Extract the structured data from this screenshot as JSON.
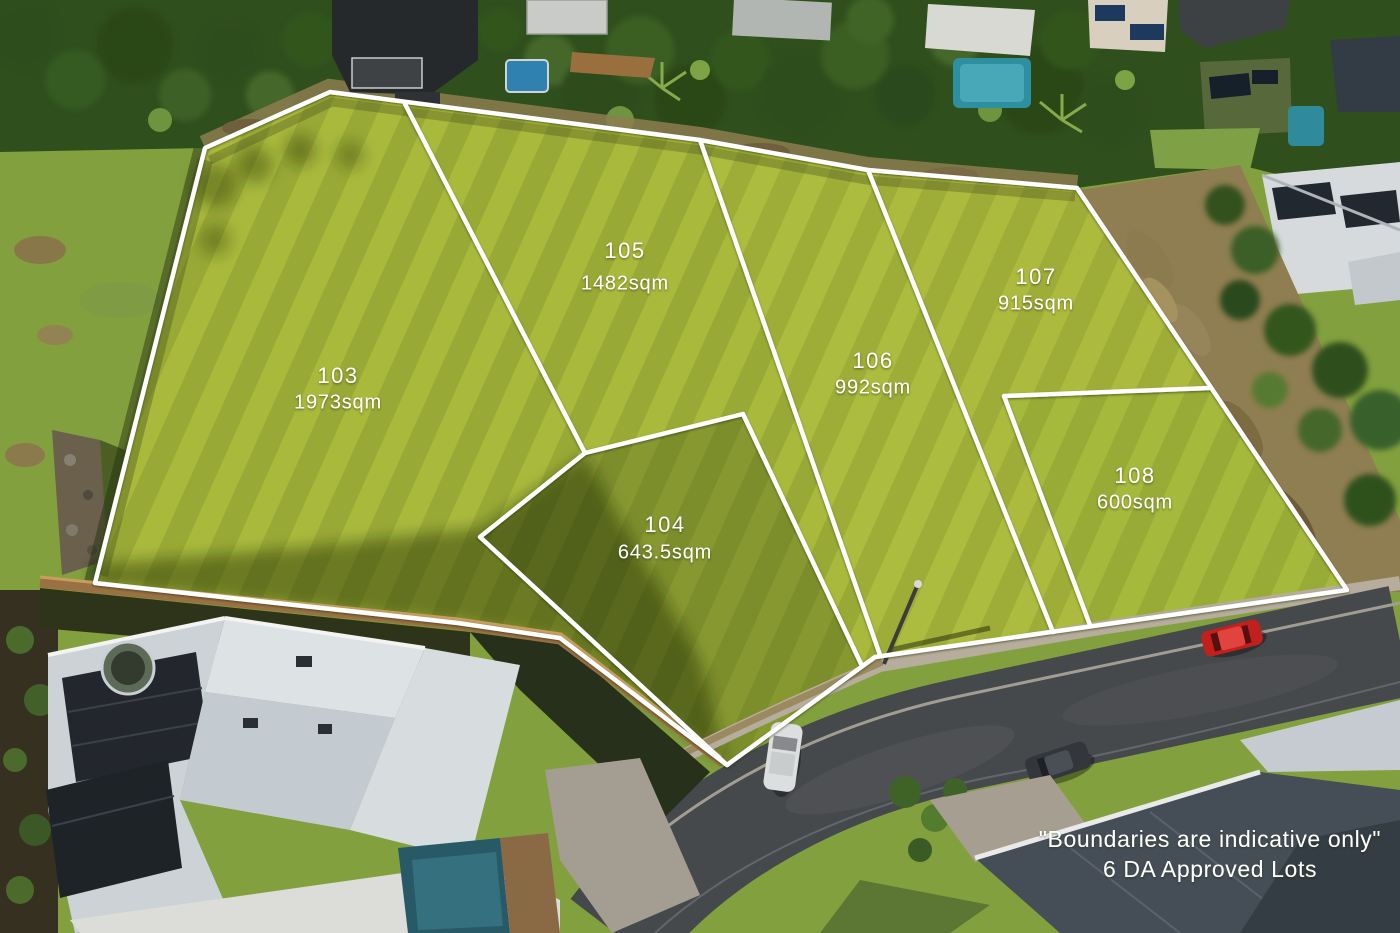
{
  "scene": {
    "type": "aerial-photograph",
    "subject": "Grassy subdivision land with surveyed lot boundaries, surrounding homes and street"
  },
  "lots": [
    {
      "number": "103",
      "area": "1973sqm"
    },
    {
      "number": "104",
      "area": "643.5sqm"
    },
    {
      "number": "105",
      "area": "1482sqm"
    },
    {
      "number": "106",
      "area": "992sqm"
    },
    {
      "number": "107",
      "area": "915sqm"
    },
    {
      "number": "108",
      "area": "600sqm"
    }
  ],
  "disclaimer": {
    "line1": "\"Boundaries are indicative only\"",
    "line2": "6 DA Approved Lots"
  },
  "colors": {
    "boundary_line": "#ffffff",
    "label_text": "#ffffff",
    "field_green": "#a9b93c",
    "road_asphalt": "#46494b",
    "tree_green": "#2e4e1c"
  }
}
